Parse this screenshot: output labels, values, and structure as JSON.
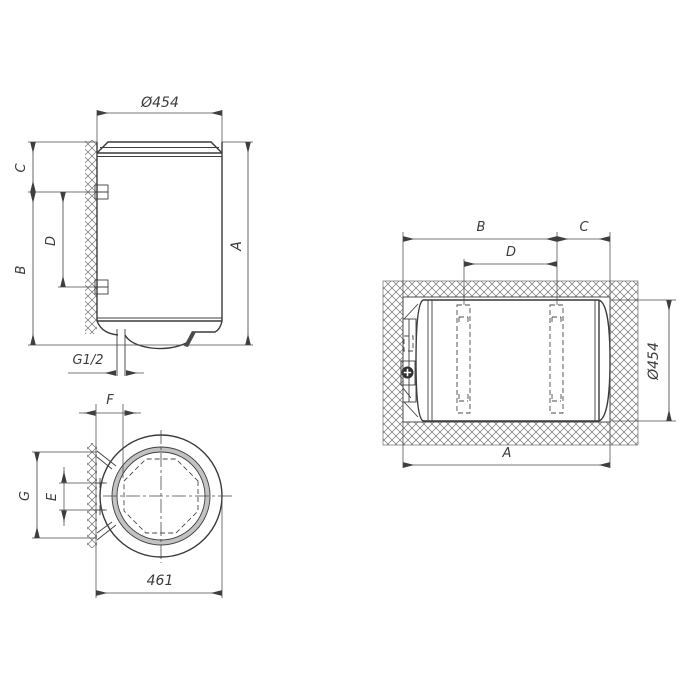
{
  "drawing": {
    "front_view": {
      "diameter_label": "Ø454",
      "dim_a": "A",
      "dim_b": "B",
      "dim_c": "C",
      "dim_d": "D",
      "thread_label": "G1/2"
    },
    "side_view": {
      "dim_a": "A",
      "dim_b": "B",
      "dim_c": "C",
      "dim_d": "D",
      "diameter_label": "Ø454"
    },
    "top_view": {
      "dim_e": "E",
      "dim_f": "F",
      "dim_g": "G",
      "width_label": "461"
    },
    "colors": {
      "line": "#3a3a3a",
      "dimension_line": "#4a4a4a",
      "hatch": "#6d6d6d",
      "ring_fill": "#c2c2c2",
      "knob_fill": "#2f2f2f",
      "background": "#ffffff"
    }
  }
}
